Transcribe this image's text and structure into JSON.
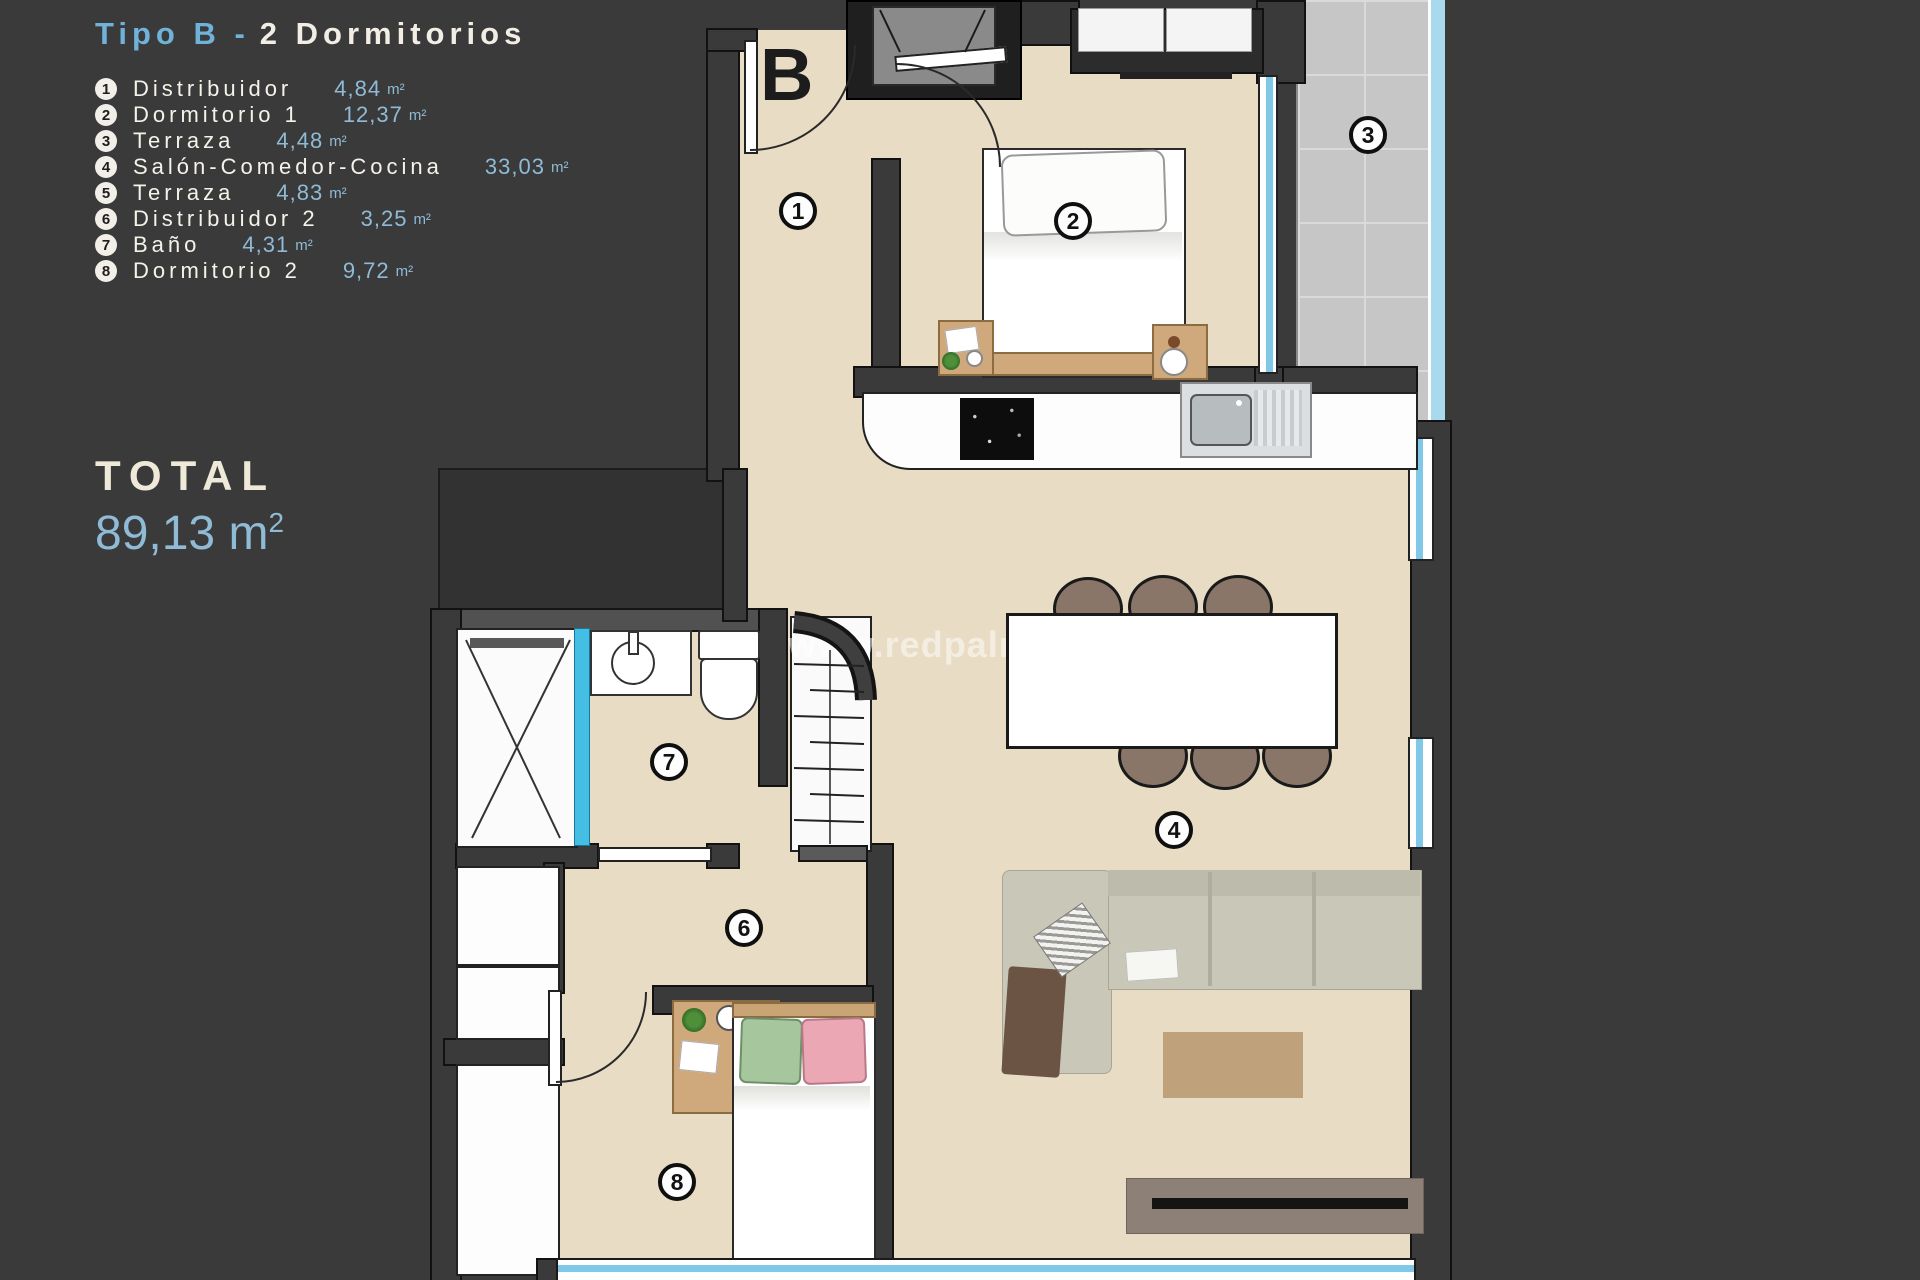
{
  "panel": {
    "title": {
      "highlight": "Tipo B -",
      "rest": "2 Dormitorios"
    },
    "legend": [
      {
        "num": "1",
        "name": "Distribuidor",
        "area": "4,84",
        "unit": "m²"
      },
      {
        "num": "2",
        "name": "Dormitorio 1",
        "area": "12,37",
        "unit": "m²"
      },
      {
        "num": "3",
        "name": "Terraza",
        "area": "4,48",
        "unit": "m²"
      },
      {
        "num": "4",
        "name": "Salón-Comedor-Cocina",
        "area": "33,03",
        "unit": "m²"
      },
      {
        "num": "5",
        "name": "Terraza",
        "area": "4,83",
        "unit": "m²"
      },
      {
        "num": "6",
        "name": "Distribuidor 2",
        "area": "3,25",
        "unit": "m²"
      },
      {
        "num": "7",
        "name": "Baño",
        "area": "4,31",
        "unit": "m²"
      },
      {
        "num": "8",
        "name": "Dormitorio 2",
        "area": "9,72",
        "unit": "m²"
      }
    ],
    "total": {
      "label": "TOTAL",
      "value": "89,13",
      "unit": "m",
      "exp": "2"
    }
  },
  "plan": {
    "block_letter": "B",
    "watermark": "www.redpalmestate",
    "labels": [
      "1",
      "2",
      "3",
      "4",
      "6",
      "7",
      "8"
    ]
  },
  "colors": {
    "background": "#3a3a3a",
    "accent_blue": "#6fb2da",
    "value_blue": "#8fbbd6",
    "cream_text": "#f2eee6",
    "floor_beige": "#e9dcc5",
    "tile_gray": "#c6c6c6",
    "glazing_blue": "#7fc8e8",
    "wood": "#cfa97b"
  }
}
